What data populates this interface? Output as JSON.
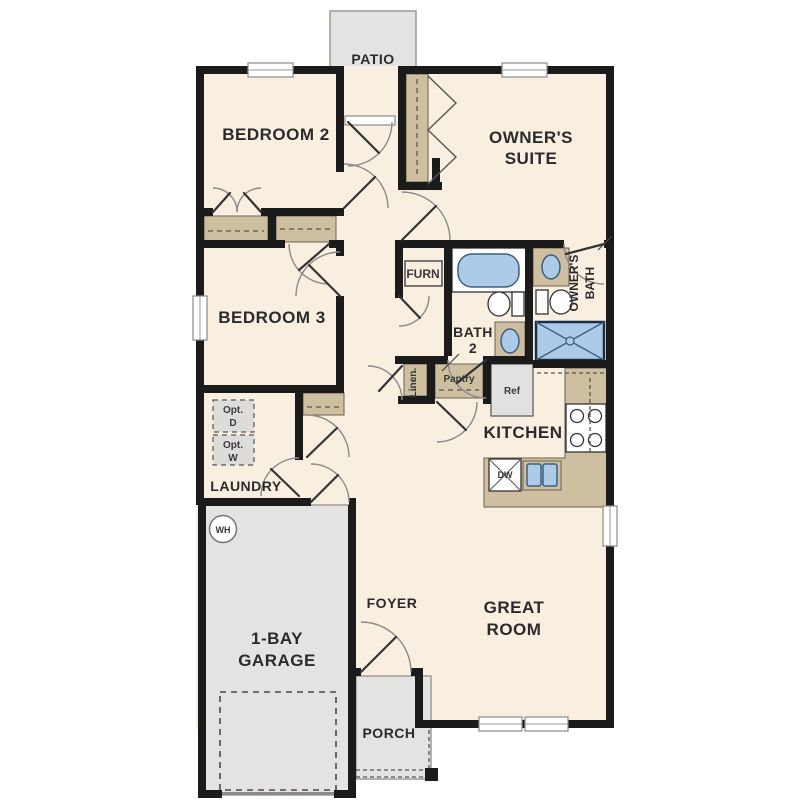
{
  "floorplan": {
    "rooms": {
      "patio": "PATIO",
      "bedroom2": "BEDROOM 2",
      "owners_suite_line1": "OWNER'S",
      "owners_suite_line2": "SUITE",
      "bedroom3": "BEDROOM 3",
      "owners_bath_line1": "OWNER'S",
      "owners_bath_line2": "BATH",
      "bath2_line1": "BATH",
      "bath2_line2": "2",
      "kitchen": "KITCHEN",
      "laundry": "LAUNDRY",
      "foyer": "FOYER",
      "great_room_line1": "GREAT",
      "great_room_line2": "ROOM",
      "garage_line1": "1-BAY",
      "garage_line2": "GARAGE",
      "porch": "PORCH"
    },
    "fixtures": {
      "furnace": "FURN",
      "linen": "Linen",
      "pantry": "Pantry",
      "refrigerator": "Ref",
      "dishwasher": "DW",
      "water_heater": "WH",
      "opt_dryer_line1": "Opt.",
      "opt_dryer_line2": "D",
      "opt_washer_line1": "Opt.",
      "opt_washer_line2": "W"
    },
    "colors": {
      "floor": "#f8efe0",
      "wall": "#1b1b1b",
      "concrete": "#e4e3e1",
      "concrete_border": "#9b9b99",
      "counter": "#cdbf9f",
      "water": "#abcbe9",
      "water_border": "#3f5f80",
      "text": "#2b2b2b"
    }
  }
}
